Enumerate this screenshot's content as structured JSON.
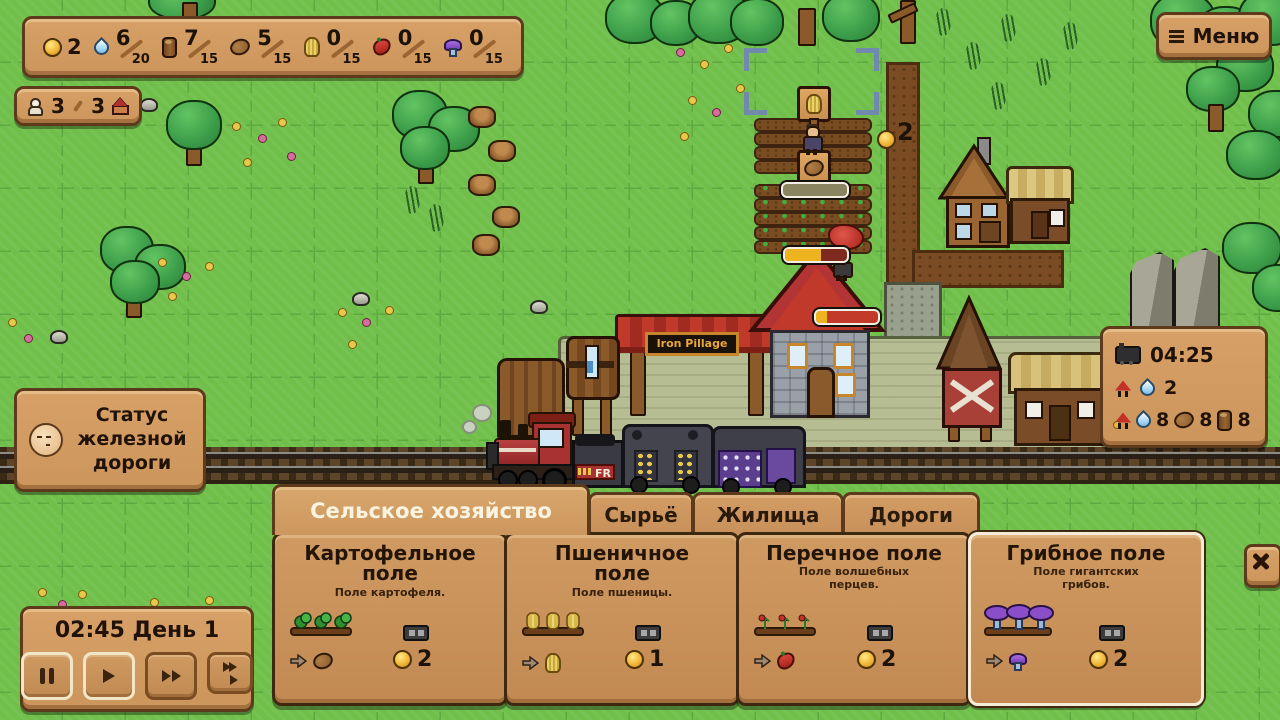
{
  "hud": {
    "coins": "2",
    "resources": [
      {
        "name": "water",
        "value": "6",
        "max": "20"
      },
      {
        "name": "wood",
        "value": "7",
        "max": "15"
      },
      {
        "name": "potato",
        "value": "5",
        "max": "15"
      },
      {
        "name": "wheat",
        "value": "0",
        "max": "15"
      },
      {
        "name": "pepper",
        "value": "0",
        "max": "15"
      },
      {
        "name": "mushroom",
        "value": "0",
        "max": "15"
      }
    ],
    "population": {
      "current": "3",
      "max": "3"
    },
    "menu_label": "Меню",
    "railroad_status_label": "Статус\nжелезной\nдороги",
    "clock": {
      "time_and_day": "02:45 День 1"
    },
    "train_schedule": {
      "arrival": "04:25",
      "passenger_water": "2",
      "cargo_water": "8",
      "cargo_potato": "8",
      "cargo_wood": "8"
    }
  },
  "map": {
    "station_sign": "Iron Pillage",
    "tender_label": "FR",
    "floating_coin": "2"
  },
  "build_menu": {
    "tabs": [
      {
        "label": "Сельское хозяйство"
      },
      {
        "label": "Сырьё"
      },
      {
        "label": "Жилища"
      },
      {
        "label": "Дороги"
      }
    ],
    "cards": [
      {
        "title": "Картофельное\nполе",
        "subtitle": "Поле картофеля.",
        "cost": "2"
      },
      {
        "title": "Пшеничное\nполе",
        "subtitle": "Поле пшеницы.",
        "cost": "1"
      },
      {
        "title": "Перечное поле",
        "subtitle": "Поле волшебных\nперцев.",
        "cost": "2"
      },
      {
        "title": "Грибное поле",
        "subtitle": "Поле гигантских\nгрибов.",
        "cost": "2"
      }
    ]
  }
}
